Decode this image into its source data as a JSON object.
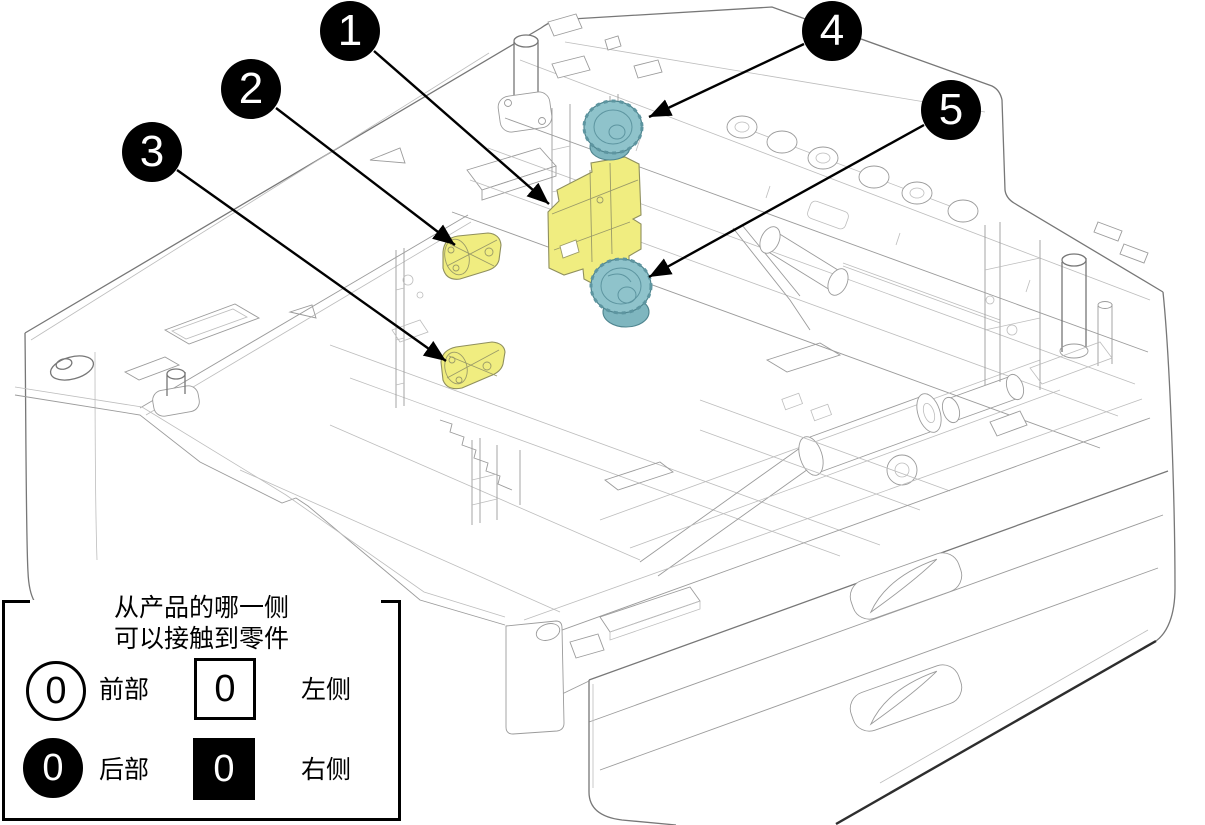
{
  "figure": {
    "callouts": [
      {
        "number": "1"
      },
      {
        "number": "2"
      },
      {
        "number": "3"
      },
      {
        "number": "4"
      },
      {
        "number": "5"
      }
    ],
    "highlight_colors": {
      "yellow_parts": "#F0ED80",
      "teal_parts": "#8FC3CB",
      "callout_background": "#000000",
      "callout_text": "#FFFFFF"
    },
    "legend": {
      "title_line1": "从产品的哪一侧",
      "title_line2": "可以接触到零件",
      "front": {
        "symbol": "0",
        "label": "前部"
      },
      "left": {
        "symbol": "0",
        "label": "左侧"
      },
      "rear": {
        "symbol": "0",
        "label": "后部"
      },
      "right": {
        "symbol": "0",
        "label": "右侧"
      }
    }
  }
}
